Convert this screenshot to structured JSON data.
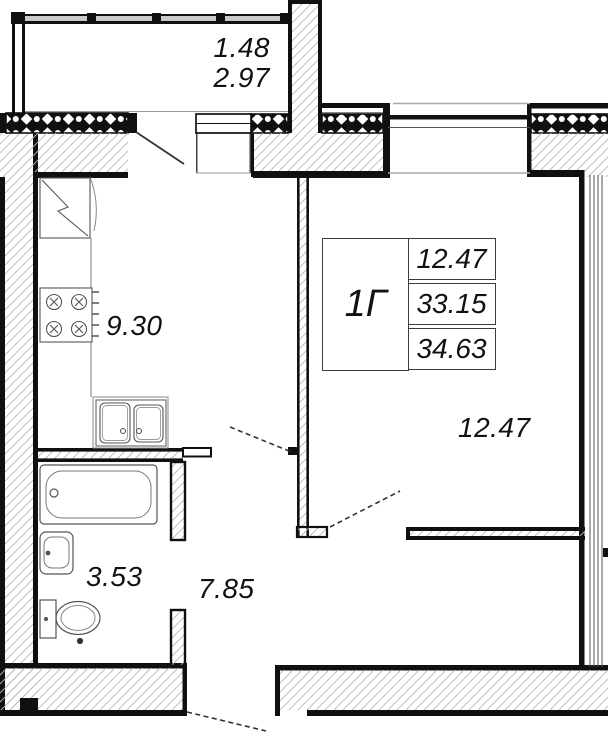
{
  "unit": {
    "label": "1Г",
    "areas": [
      "12.47",
      "33.15",
      "34.63"
    ]
  },
  "labels": {
    "balcony_line1": "1.48",
    "balcony_line2": "2.97",
    "kitchen": "9.30",
    "room": "12.47",
    "bathroom": "3.53",
    "hallway": "7.85"
  },
  "colors": {
    "ink": "#101010",
    "hatch": "#b8b8b8"
  }
}
